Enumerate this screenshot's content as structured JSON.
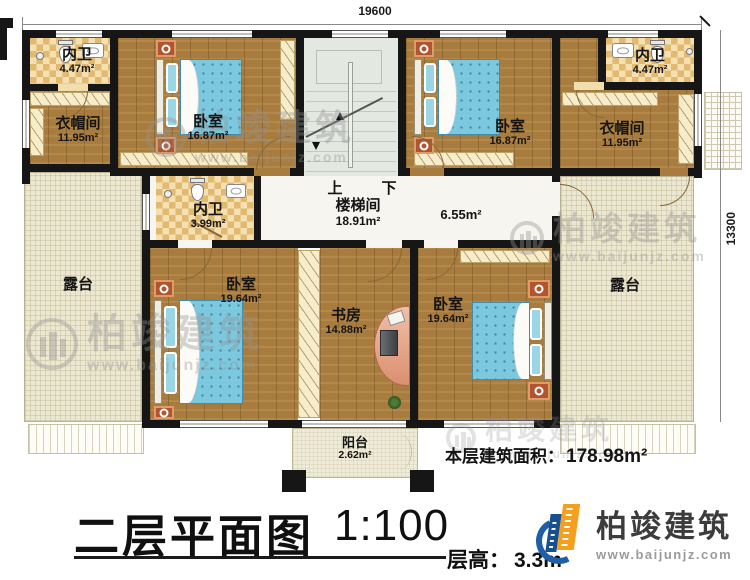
{
  "dims": {
    "top": "19600",
    "right": "13300"
  },
  "stairs": {
    "name": "楼梯间",
    "area": "18.91m²",
    "up": "上",
    "down": "下"
  },
  "rooms": {
    "bath_tl": {
      "name": "内卫",
      "area": "4.47m²"
    },
    "closet_tl": {
      "name": "衣帽间",
      "area": "11.95m²"
    },
    "bedroom_tl": {
      "name": "卧室",
      "area": "16.87m²"
    },
    "bedroom_tr": {
      "name": "卧室",
      "area": "16.87m²"
    },
    "bath_tr": {
      "name": "内卫",
      "area": "4.47m²"
    },
    "closet_tr": {
      "name": "衣帽间",
      "area": "11.95m²"
    },
    "bath_mid": {
      "name": "内卫",
      "area": "3.99m²"
    },
    "hall": {
      "area": "6.55m²"
    },
    "terrace_left": {
      "name": "露台"
    },
    "terrace_right": {
      "name": "露台"
    },
    "bedroom_bl": {
      "name": "卧室",
      "area": "19.64m²"
    },
    "study": {
      "name": "书房",
      "area": "14.88m²"
    },
    "bedroom_br": {
      "name": "卧室",
      "area": "19.64m²"
    },
    "balcony": {
      "name": "阳台",
      "area": "2.62m²"
    }
  },
  "titleblock": {
    "title": "二层平面图",
    "scale": "1:100",
    "floor_area_label": "本层建筑面积：",
    "floor_area_value": "178.98m²",
    "floor_height_label": "层高：",
    "floor_height_value": "3.3m"
  },
  "brand": {
    "name": "柏竣建筑",
    "url": "www.baijunjz.com"
  },
  "watermark": {
    "name": "柏竣建筑",
    "url": "www.baijunjz.com"
  },
  "colors": {
    "wall": "#161616",
    "wood": "#a87c3e",
    "tile_light": "#f4e0b0",
    "tile_dark": "#e2b971",
    "terrace": "#ebe7d1",
    "stair": "#e3e8e1",
    "hall": "#f6f5f0",
    "bed": "#7cc8de",
    "brand_blue": "#1b5fa6",
    "brand_orange": "#f59f1e"
  }
}
